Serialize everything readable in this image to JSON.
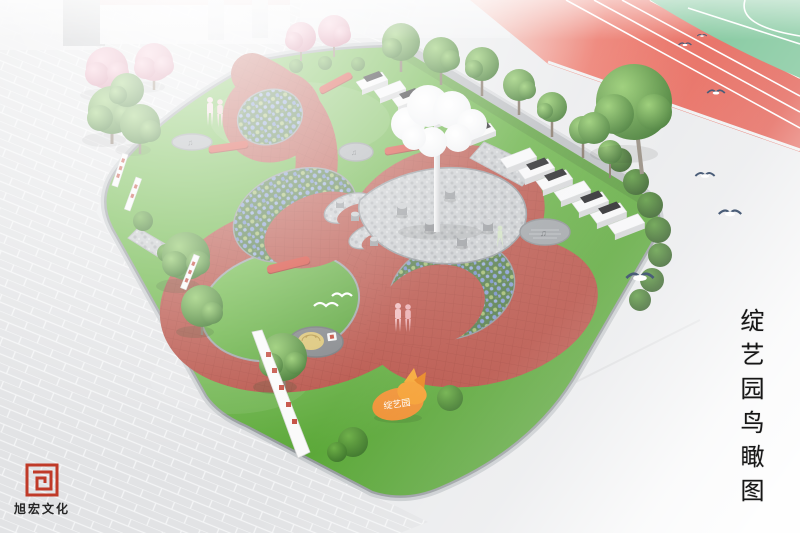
{
  "title": {
    "vertical_text": "绽艺园鸟瞰图"
  },
  "logo": {
    "text": "旭宏文化"
  },
  "signs": {
    "garden_sculpture_label": "绽艺园"
  },
  "icons": {
    "music_notes": "♫"
  },
  "colors": {
    "clef_path_red": "#b54b40",
    "lawn_light": "#6cbb43",
    "lawn_dark": "#4f9c2f",
    "track_red": "#e25a4e",
    "field_green": "#7ac497",
    "plaza_gray": "#e2e3e5",
    "concrete_gray": "#e9eaec",
    "bench_red": "#d43d2f",
    "sign_orange": "#ef8c2a",
    "seal_red": "#c03a28",
    "cloud_white": "#fdfdfe",
    "flower_blue": "#7d96cf"
  }
}
